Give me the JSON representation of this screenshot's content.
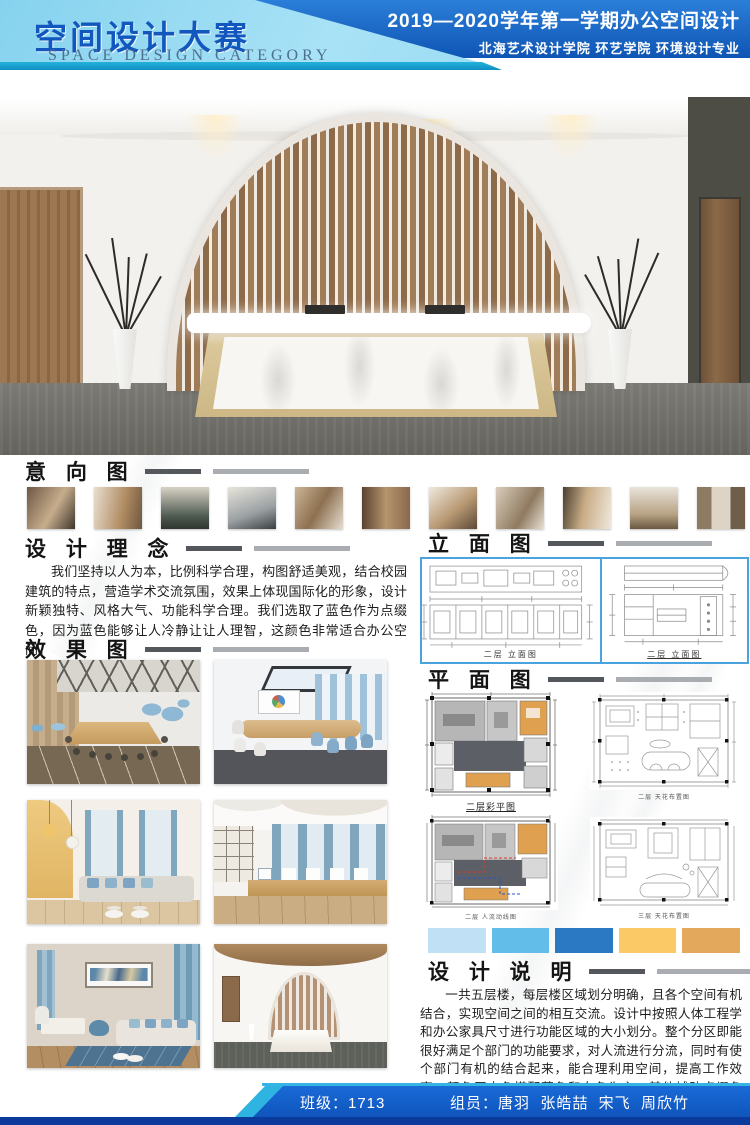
{
  "header": {
    "title_cn": "空间设计大赛",
    "title_en": "SPACE DESIGN CATEGORY",
    "course_line": "2019—2020学年第一学期办公空间设计",
    "school_line": "北海艺术设计学院  环艺学院  环境设计专业"
  },
  "sections": {
    "intent": "意 向 图",
    "concept": "设 计 理 念",
    "effect": "效 果 图",
    "elevation": "立 面 图",
    "plan": "平 面 图",
    "notes": "设 计 说 明"
  },
  "concept_text": "我们坚持以人为本，比例科学合理，构图舒适美观，结合校园建筑的特点，营造学术交流氛围，效果上体现国际化的形象，设计新颖独特、风格大气、功能科学合理。我们选取了蓝色作为点缀色，因为蓝色能够让人冷静让让人理智，这颜色非常适合办公空间。",
  "notes_text": "一共五层楼，每层楼区域划分明确，且各个空间有机结合，实现空间之间的相互交流。设计中按照人体工程学和办公家具尺寸进行功能区域的大小划分。整个分区即能很好满足个部门的功能要求，对人流进行分流，同时有使个部门有机的结合起来，能合理利用空间，提高工作效率。颜色原木色搭配蓝色和白色为主，其他辅助点缀色彩，简单大气。让人感受到舒心自在有一个良好的办公空间。",
  "elevation_captions": [
    "二层 立面图",
    "二层 立面图"
  ],
  "plan_captions": [
    "二层彩平图",
    "二层 天花布置图",
    "二层 人流动线图",
    "三层 天花布置图"
  ],
  "palette": [
    "#bfe0f5",
    "#63bde9",
    "#2a79c2",
    "#fbca67",
    "#e3a85b"
  ],
  "footer": {
    "class_label": "班级：1713",
    "members_label": "组员：唐羽  张皓喆  宋飞  周欣竹"
  }
}
